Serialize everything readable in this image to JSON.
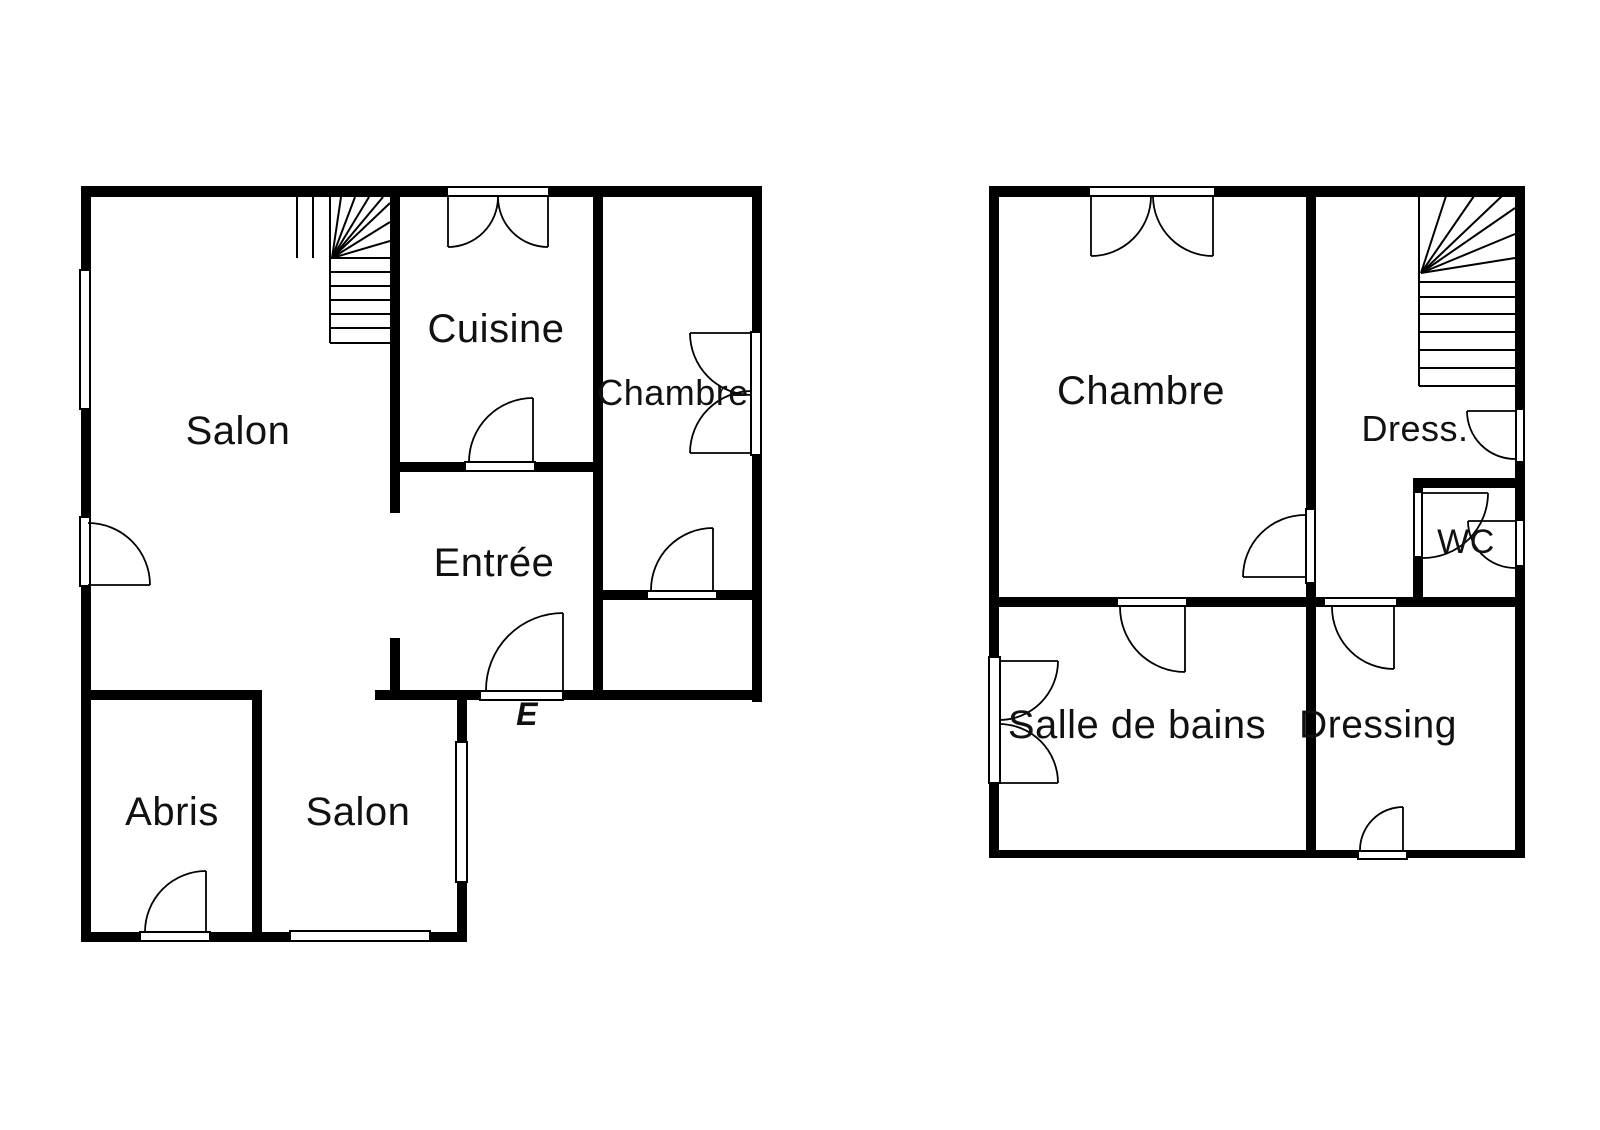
{
  "title": "Plans d'étage - maison (rez-de-chaussée et étage)",
  "colors": {
    "background": "#ffffff",
    "wall": "#000000",
    "line": "#000000",
    "text": "#111111"
  },
  "plans": [
    {
      "id": "ground-floor",
      "rooms": [
        {
          "id": "salon",
          "label": "Salon",
          "x": 238,
          "y": 431,
          "size": 40
        },
        {
          "id": "cuisine",
          "label": "Cuisine",
          "x": 496,
          "y": 329,
          "size": 40
        },
        {
          "id": "chambre",
          "label": "Chambre",
          "x": 673,
          "y": 393,
          "size": 36
        },
        {
          "id": "entree",
          "label": "Entrée",
          "x": 494,
          "y": 563,
          "size": 40
        },
        {
          "id": "abris",
          "label": "Abris",
          "x": 172,
          "y": 812,
          "size": 40
        },
        {
          "id": "salon-bas",
          "label": "Salon",
          "x": 358,
          "y": 812,
          "size": 40
        }
      ],
      "entrance_label": {
        "text": "E",
        "x": 527,
        "y": 714,
        "size": 32,
        "italic": true
      },
      "walls": [
        [
          81,
          186,
          681,
          11
        ],
        [
          81,
          197,
          10,
          73
        ],
        [
          81,
          409,
          10,
          108
        ],
        [
          81,
          586,
          10,
          356
        ],
        [
          752,
          197,
          10,
          135
        ],
        [
          752,
          455,
          10,
          247
        ],
        [
          375,
          690,
          105,
          10
        ],
        [
          563,
          690,
          199,
          10
        ],
        [
          81,
          690,
          181,
          10
        ],
        [
          252,
          700,
          10,
          232
        ],
        [
          81,
          932,
          59,
          10
        ],
        [
          210,
          932,
          80,
          10
        ],
        [
          430,
          932,
          37,
          10
        ],
        [
          457,
          700,
          10,
          42
        ],
        [
          457,
          882,
          10,
          50
        ],
        [
          390,
          186,
          10,
          327
        ],
        [
          390,
          638,
          10,
          52
        ],
        [
          593,
          186,
          10,
          514
        ],
        [
          400,
          462,
          65,
          10
        ],
        [
          535,
          462,
          58,
          10
        ],
        [
          603,
          590,
          44,
          10
        ],
        [
          717,
          590,
          35,
          10
        ]
      ],
      "openings": [
        [
          80,
          270,
          10,
          139
        ],
        [
          80,
          517,
          10,
          69
        ],
        [
          751,
          332,
          10,
          123
        ],
        [
          456,
          742,
          11,
          140
        ],
        [
          290,
          931,
          140,
          10
        ],
        [
          140,
          932,
          70,
          9
        ],
        [
          447,
          187,
          102,
          9
        ],
        [
          465,
          462,
          70,
          9
        ],
        [
          480,
          691,
          83,
          9
        ],
        [
          647,
          591,
          70,
          8
        ]
      ],
      "doors": [
        "M448,197 L448,247 M448,247 A50,50 0 0 0 498,197",
        "M548,197 L548,247 M548,247 A50,50 0 0 1 498,197",
        "M533,398 L533,462 M533,398 A64,64 0 0 0 469,462",
        "M690,333 L752,333 M690,333 A62,62 0 0 0 752,395",
        "M690,453 L752,453 M690,453 A62,62 0 0 1 752,391",
        "M713,528 L713,590 M713,528 A62,62 0 0 0 651,590",
        "M563,613 L563,690 M563,613 A77,77 0 0 0 486,690",
        "M88,585 L150,585 M150,585 A62,62 0 0 0 88,523",
        "M206,871 L206,932 M206,871 A61,61 0 0 0 145,932"
      ],
      "stairs": [
        [
          297,
          197,
          297,
          258
        ],
        [
          313,
          197,
          313,
          258
        ],
        [
          330,
          197,
          330,
          258
        ],
        [
          330,
          258,
          390,
          258
        ],
        [
          330,
          272,
          390,
          272
        ],
        [
          330,
          286,
          390,
          286
        ],
        [
          330,
          300,
          390,
          300
        ],
        [
          330,
          314,
          390,
          314
        ],
        [
          330,
          328,
          390,
          328
        ],
        [
          330,
          343,
          390,
          343
        ],
        [
          330,
          258,
          330,
          343
        ],
        [
          332,
          258,
          341,
          197
        ],
        [
          332,
          258,
          355,
          197
        ],
        [
          332,
          258,
          369,
          197
        ],
        [
          332,
          258,
          383,
          197
        ],
        [
          332,
          258,
          390,
          203
        ],
        [
          332,
          258,
          390,
          222
        ],
        [
          332,
          258,
          390,
          241
        ]
      ]
    },
    {
      "id": "first-floor",
      "rooms": [
        {
          "id": "chambre",
          "label": "Chambre",
          "x": 1141,
          "y": 391,
          "size": 40
        },
        {
          "id": "dress",
          "label": "Dress.",
          "x": 1415,
          "y": 429,
          "size": 36
        },
        {
          "id": "wc",
          "label": "WC",
          "x": 1466,
          "y": 542,
          "size": 34
        },
        {
          "id": "salle-de-bains",
          "label": "Salle de bains",
          "x": 1137,
          "y": 725,
          "size": 40
        },
        {
          "id": "dressing",
          "label": "Dressing",
          "x": 1378,
          "y": 725,
          "size": 39
        }
      ],
      "walls": [
        [
          989,
          186,
          536,
          11
        ],
        [
          989,
          197,
          10,
          460
        ],
        [
          989,
          783,
          10,
          75
        ],
        [
          1515,
          197,
          10,
          212
        ],
        [
          1515,
          462,
          10,
          58
        ],
        [
          1515,
          566,
          10,
          292
        ],
        [
          989,
          850,
          369,
          8
        ],
        [
          1407,
          850,
          118,
          8
        ],
        [
          1306,
          196,
          10,
          313
        ],
        [
          1306,
          583,
          10,
          14
        ],
        [
          989,
          597,
          128,
          10
        ],
        [
          1187,
          597,
          137,
          10
        ],
        [
          1397,
          597,
          128,
          10
        ],
        [
          1306,
          607,
          10,
          243
        ],
        [
          1413,
          478,
          112,
          10
        ],
        [
          1413,
          478,
          10,
          14
        ],
        [
          1413,
          557,
          10,
          40
        ]
      ],
      "openings": [
        [
          989,
          657,
          11,
          126
        ],
        [
          1089,
          187,
          126,
          9
        ],
        [
          1306,
          509,
          9,
          74
        ],
        [
          1117,
          598,
          70,
          8
        ],
        [
          1324,
          598,
          73,
          8
        ],
        [
          1358,
          851,
          49,
          8
        ],
        [
          1414,
          492,
          8,
          65
        ],
        [
          1516,
          520,
          8,
          46
        ],
        [
          1516,
          409,
          8,
          53
        ]
      ],
      "doors": [
        "M1091,196 L1091,256 M1091,256 A60,60 0 0 0 1151,196",
        "M1213,196 L1213,256 M1213,256 A60,60 0 0 1 1153,196",
        "M1243,577 L1305,577 M1243,577 A62,62 0 0 1 1305,515",
        "M1423,493 L1488,493 M1488,493 A65,65 0 0 1 1423,558",
        "M1468,521 L1515,521 M1468,521 A47,47 0 0 0 1515,568",
        "M1467,411 L1515,411 M1467,411 A48,48 0 0 0 1515,459",
        "M999,661 L1058,661 M1058,661 A59,59 0 0 1 999,720",
        "M999,783 L1058,783 M1058,783 A59,59 0 0 0 999,724",
        "M1185,607 L1185,672 M1185,672 A65,65 0 0 1 1120,607",
        "M1394,607 L1394,669 M1394,669 A62,62 0 0 1 1332,607",
        "M1403,807 L1403,850 M1403,807 A43,43 0 0 0 1360,850"
      ],
      "stairs": [
        [
          1419,
          196,
          1419,
          386
        ],
        [
          1419,
          282,
          1515,
          282
        ],
        [
          1419,
          297,
          1515,
          297
        ],
        [
          1419,
          314,
          1515,
          314
        ],
        [
          1419,
          332,
          1515,
          332
        ],
        [
          1419,
          350,
          1515,
          350
        ],
        [
          1419,
          368,
          1515,
          368
        ],
        [
          1419,
          386,
          1515,
          386
        ],
        [
          1421,
          273,
          1446,
          196
        ],
        [
          1421,
          273,
          1474,
          196
        ],
        [
          1421,
          273,
          1502,
          196
        ],
        [
          1421,
          273,
          1515,
          208
        ],
        [
          1421,
          273,
          1515,
          234
        ],
        [
          1421,
          273,
          1515,
          258
        ]
      ]
    }
  ]
}
